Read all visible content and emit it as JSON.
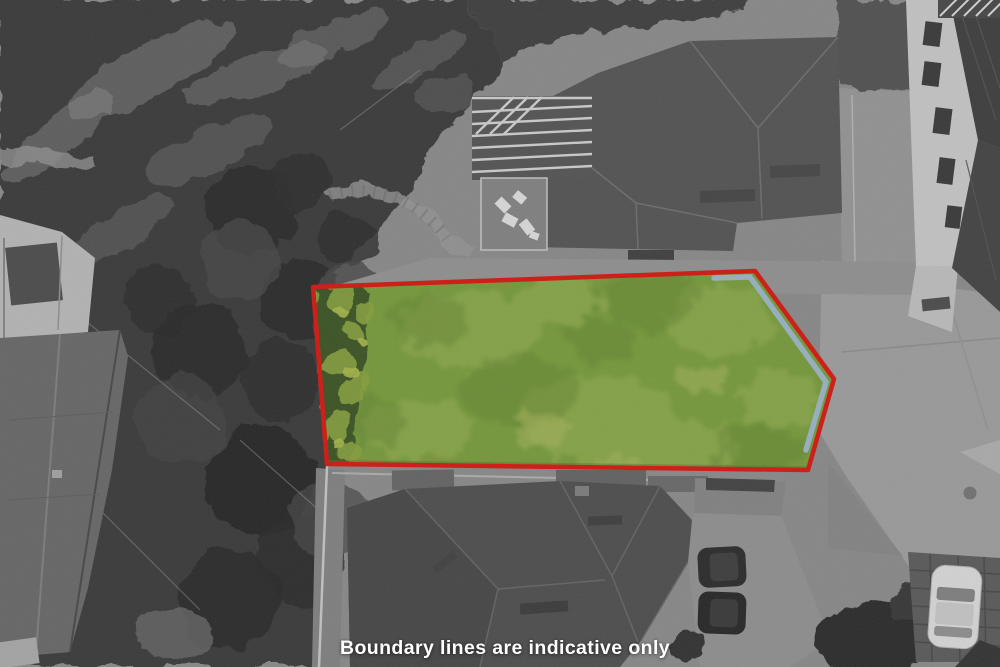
{
  "photo": {
    "kind": "aerial-drone-photograph",
    "treatment": "surroundings desaturated to grayscale; highlighted section shown in colour",
    "caption": {
      "text": "Boundary lines are indicative only",
      "color": "#ffffff"
    }
  },
  "boundary": {
    "color": "#e8140c",
    "stroke_width": 4.5,
    "points": "313,287 755,271 834,379 808,470 327,464"
  },
  "lot": {
    "grass_base": "#7fa73c",
    "grass_light": "#a6bf58",
    "grass_dark": "#688f31",
    "patch_yellow": "#b9c863",
    "shrub_dark": "#3d5822",
    "shrub_light": "#92ae3f",
    "edge_strip": {
      "color": "#a6c4d6",
      "points": "714,278 750,277 826,382 806,450",
      "stroke_width": 5.5
    }
  }
}
